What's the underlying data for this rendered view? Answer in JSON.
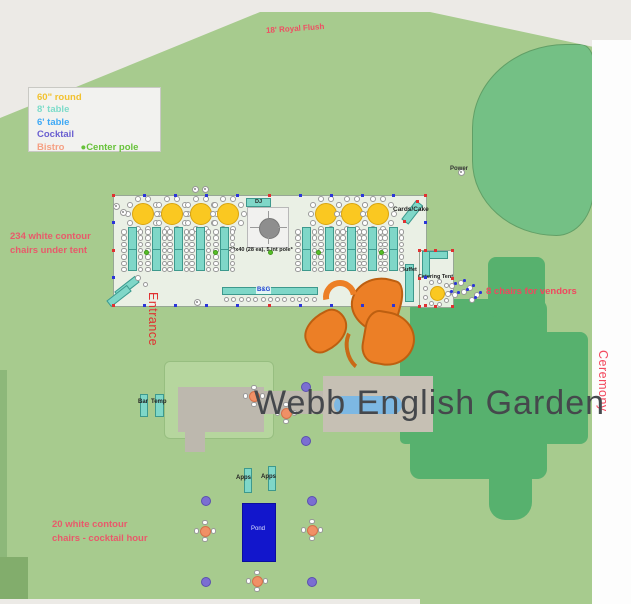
{
  "map_label": "Webb English Garden",
  "legend": {
    "items": [
      {
        "label": "60\" round",
        "color": "#f2c230"
      },
      {
        "label": "8' table",
        "color": "#7edcca"
      },
      {
        "label": "6' table",
        "color": "#3fa9f5"
      },
      {
        "label": "Cocktail",
        "color": "#6a5fd0"
      },
      {
        "label": "Bistro",
        "color": "#f5a083"
      }
    ],
    "center_pole_label": "Center pole",
    "center_pole_color": "#67c23a"
  },
  "annotations": {
    "royal_flush": "18' Royal Flush",
    "tent_chairs": "234 white contour chairs under tent",
    "vendor_chairs": "8 chairs for vendors",
    "cocktail_chairs": "20 white contour chairs - cocktail hour",
    "entrance": "Entrance",
    "ceremony": "Ceremony",
    "power": "Power"
  },
  "tent_labels": {
    "dj": "DJ",
    "spec": "*20x40 (28 ea), 5 int pole*",
    "head_table": "B&G",
    "cards_cake": "Cards/Cake",
    "buffet": "Buffet",
    "catering_tent": "Catering Tent"
  },
  "area_labels": {
    "bar": "Bar",
    "temp": "Temp",
    "apps_left": "Apps",
    "apps_right": "Apps",
    "pond": "Pond"
  },
  "objects": {
    "round_tables": [
      [
        143,
        214,
        11,
        10
      ],
      [
        172,
        214,
        11,
        10
      ],
      [
        201,
        214,
        11,
        10
      ],
      [
        228,
        214,
        11,
        10
      ],
      [
        326,
        214,
        11,
        10
      ],
      [
        352,
        214,
        11,
        10
      ],
      [
        378,
        214,
        11,
        10
      ],
      [
        437,
        293,
        7.5,
        9
      ]
    ],
    "long_tables_x": [
      132,
      156,
      178,
      200,
      224,
      306,
      329,
      351,
      372,
      393
    ],
    "long_table_top": 227,
    "long_table_height": 44,
    "head_table_chairs": 13,
    "center_poles": [
      [
        146,
        252
      ],
      [
        215,
        252
      ],
      [
        270,
        252
      ],
      [
        318,
        252
      ],
      [
        381,
        252
      ]
    ],
    "purple_dots": [
      [
        306,
        387
      ],
      [
        306,
        441
      ],
      [
        206,
        501
      ],
      [
        312,
        501
      ],
      [
        206,
        582
      ],
      [
        312,
        582
      ]
    ],
    "bistro_tables": [
      [
        254,
        396
      ],
      [
        286,
        413
      ],
      [
        205,
        531
      ],
      [
        312,
        530
      ],
      [
        257,
        581
      ]
    ],
    "vendor_chairs": [
      [
        452,
        286
      ],
      [
        461,
        283
      ],
      [
        470,
        288
      ],
      [
        477,
        295
      ],
      [
        455,
        295
      ],
      [
        464,
        292
      ],
      [
        472,
        300
      ],
      [
        448,
        294
      ]
    ],
    "utility_circles": [
      [
        116,
        206
      ],
      [
        123,
        212
      ],
      [
        195,
        189
      ],
      [
        205,
        189
      ],
      [
        197,
        302
      ],
      [
        461,
        172
      ]
    ],
    "gift_chairs": [
      [
        138,
        278,
        6
      ],
      [
        145,
        284,
        5
      ]
    ],
    "cards_dots": [
      [
        417,
        201
      ],
      [
        404,
        221
      ]
    ]
  }
}
